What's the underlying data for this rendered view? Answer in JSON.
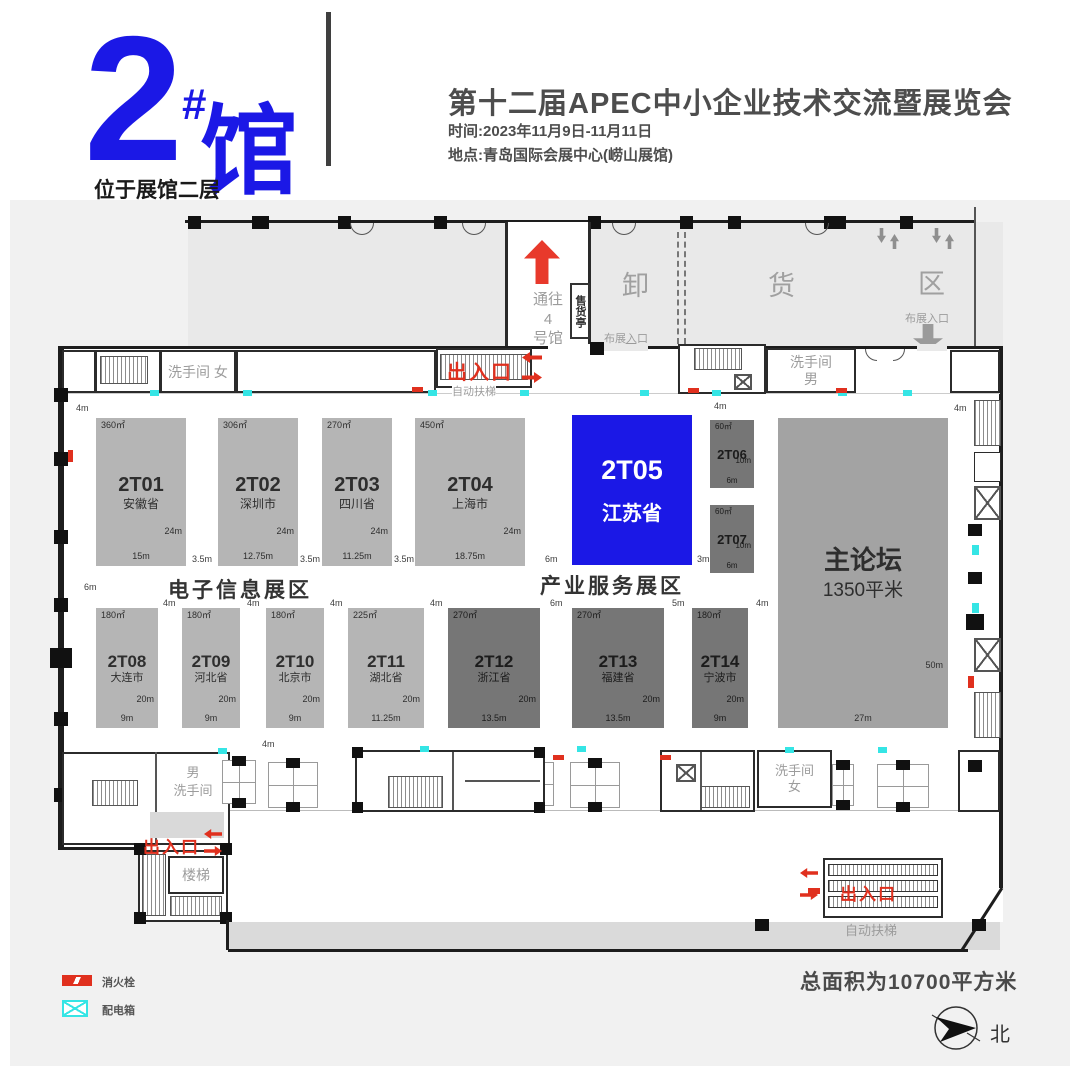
{
  "colors": {
    "accent_blue": "#1b18e6",
    "booth_light": "#b5b5b5",
    "booth_dark": "#767676",
    "forum_gray": "#a3a3a3",
    "exit_red": "#e0301e",
    "power_cyan": "#35e5e5"
  },
  "header": {
    "hall_number": "2",
    "hall_hash": "#",
    "hall_word": "馆",
    "hall_note": "位于展馆二层",
    "title": "第十二届APEC中小企业技术交流暨展览会",
    "time": "时间:2023年11月9日-11月11日",
    "venue": "地点:青岛国际会展中心(崂山展馆)"
  },
  "plan": {
    "top": {
      "to_hall4": [
        "通往",
        "4",
        "号馆"
      ],
      "kiosk": "售货亭",
      "unloading": [
        "卸",
        "货",
        "区"
      ],
      "setup_entrance": "布展入口",
      "exit": "出入口",
      "escalator": "自动扶梯",
      "restroom_female": "洗手间 女",
      "restroom_male": [
        "洗手间",
        "男"
      ]
    },
    "zones": {
      "electronics": "电子信息展区",
      "industry": "产业服务展区"
    },
    "dims": {
      "m3": "3m",
      "m4": "4m",
      "m5": "5m",
      "m6": "6m",
      "m35": "3.5m",
      "m57": "5.7m",
      "m87": "8.7m",
      "m37": "3.7m",
      "m39": "3.9m"
    },
    "booths": [
      {
        "id": "2T01",
        "name": "安徽省",
        "area": "360㎡",
        "depth": "24m",
        "width": "15m"
      },
      {
        "id": "2T02",
        "name": "深圳市",
        "area": "306㎡",
        "depth": "24m",
        "width": "12.75m"
      },
      {
        "id": "2T03",
        "name": "四川省",
        "area": "270㎡",
        "depth": "24m",
        "width": "11.25m"
      },
      {
        "id": "2T04",
        "name": "上海市",
        "area": "450㎡",
        "depth": "24m",
        "width": "18.75m"
      },
      {
        "id": "2T05",
        "name": "江苏省",
        "area": "",
        "depth": "",
        "width": ""
      },
      {
        "id": "2T06",
        "name": "",
        "area": "60㎡",
        "depth": "10m",
        "width": "6m"
      },
      {
        "id": "2T07",
        "name": "",
        "area": "60㎡",
        "depth": "10m",
        "width": "6m"
      },
      {
        "id": "2T08",
        "name": "大连市",
        "area": "180㎡",
        "depth": "20m",
        "width": "9m"
      },
      {
        "id": "2T09",
        "name": "河北省",
        "area": "180㎡",
        "depth": "20m",
        "width": "9m"
      },
      {
        "id": "2T10",
        "name": "北京市",
        "area": "180㎡",
        "depth": "20m",
        "width": "9m"
      },
      {
        "id": "2T11",
        "name": "湖北省",
        "area": "225㎡",
        "depth": "20m",
        "width": "11.25m"
      },
      {
        "id": "2T12",
        "name": "浙江省",
        "area": "270㎡",
        "depth": "20m",
        "width": "13.5m"
      },
      {
        "id": "2T13",
        "name": "福建省",
        "area": "270㎡",
        "depth": "20m",
        "width": "13.5m"
      },
      {
        "id": "2T14",
        "name": "宁波市",
        "area": "180㎡",
        "depth": "20m",
        "width": "9m"
      }
    ],
    "forum": {
      "name": "主论坛",
      "area": "1350平米",
      "depth": "50m",
      "width": "27m"
    },
    "bottom": {
      "restroom_male": [
        "男",
        "洗手间"
      ],
      "exit": "出入口",
      "stairs": "楼梯",
      "restroom_female": [
        "洗手间",
        "女"
      ],
      "escalator": "自动扶梯"
    },
    "legend": [
      {
        "label": "消火栓"
      },
      {
        "label": "配电箱"
      }
    ],
    "footer": {
      "total_area": "总面积为10700平方米",
      "north": "北"
    }
  }
}
